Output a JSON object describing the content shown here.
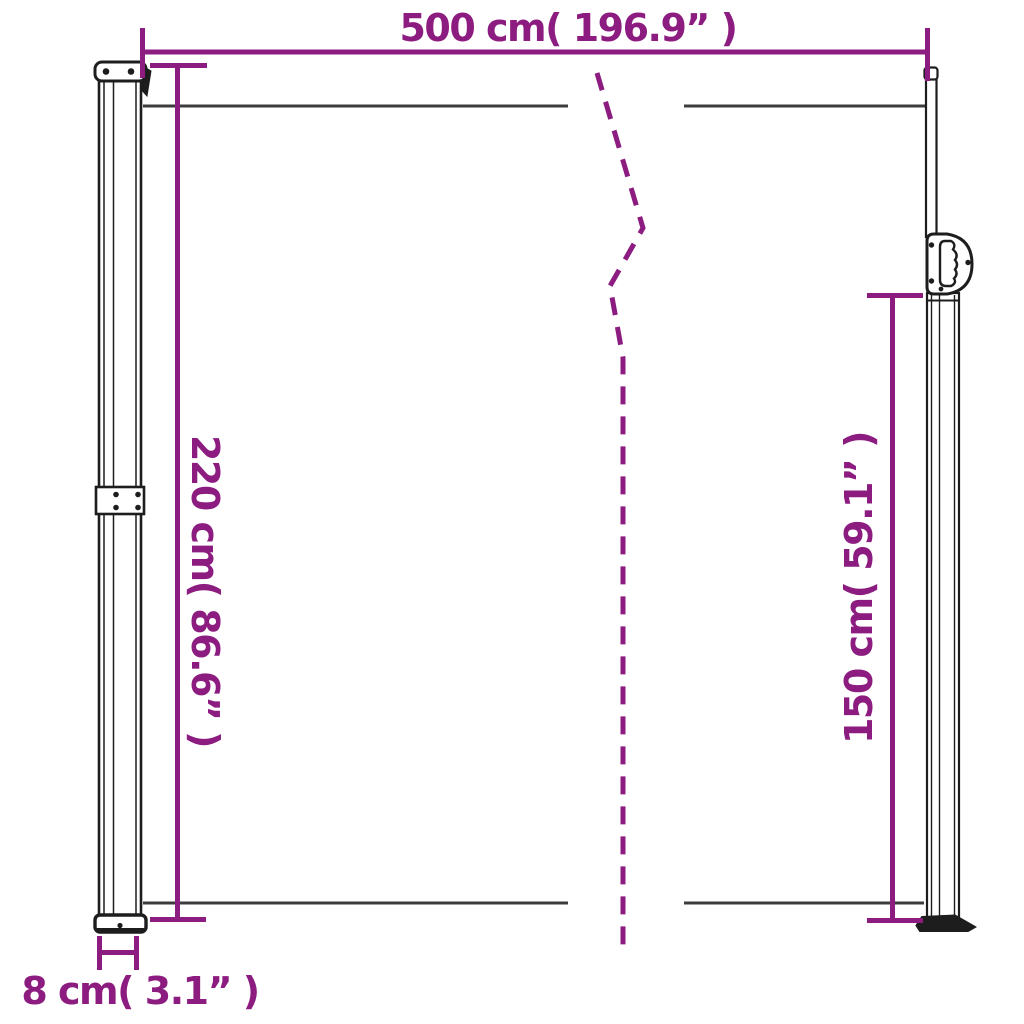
{
  "colors": {
    "accent": "#8C1C80",
    "line_dark": "#3C3C3C",
    "outline": "#1D1D1D",
    "background": "#FFFFFF"
  },
  "labels": {
    "width": "500 cm( 196.9” )",
    "height_left": "220 cm( 86.6” )",
    "height_right": "150 cm( 59.1” )",
    "depth": "8 cm( 3.1” )"
  }
}
